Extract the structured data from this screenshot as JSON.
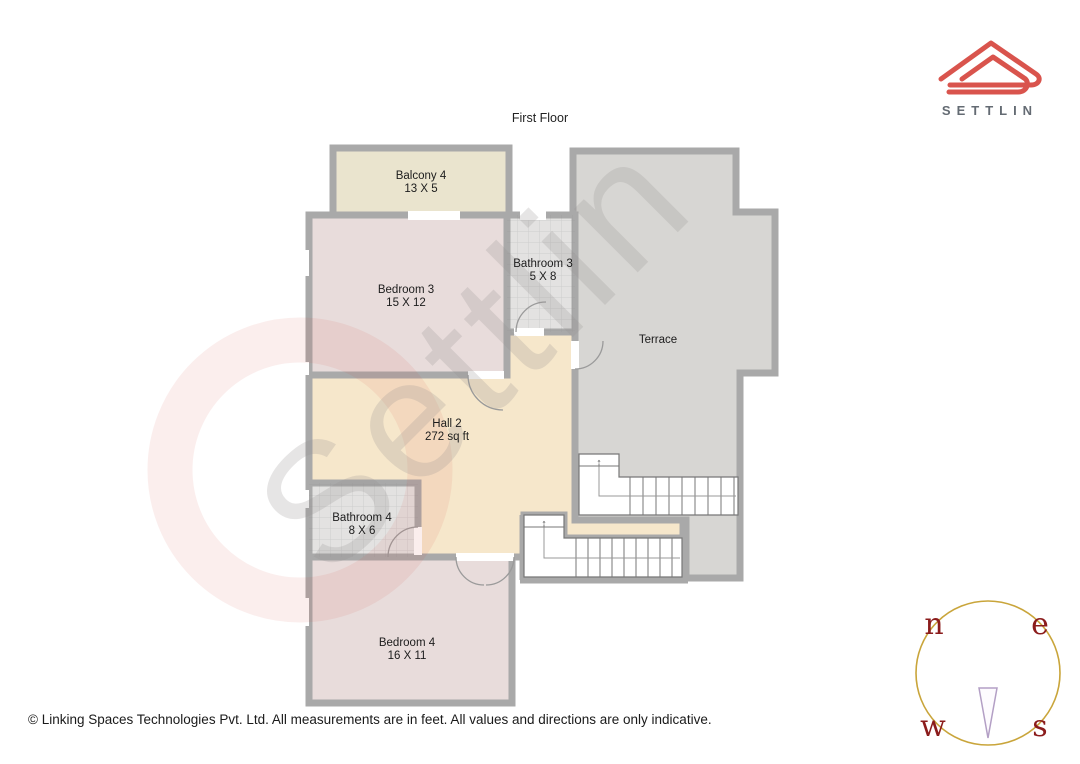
{
  "header": {
    "title": "First Floor"
  },
  "logo": {
    "brand": "SETTLIN"
  },
  "rooms": {
    "balcony4": {
      "name": "Balcony 4",
      "dims": "13 X 5"
    },
    "bedroom3": {
      "name": "Bedroom 3",
      "dims": "15 X 12"
    },
    "bathroom3": {
      "name": "Bathroom 3",
      "dims": "5 X 8"
    },
    "terrace": {
      "name": "Terrace"
    },
    "hall2": {
      "name": "Hall 2",
      "dims": "272 sq ft"
    },
    "bathroom4": {
      "name": "Bathroom 4",
      "dims": "8 X 6"
    },
    "bedroom4": {
      "name": "Bedroom 4",
      "dims": "16 X 11"
    }
  },
  "stairs": {
    "up_arrow": "↑"
  },
  "compass": {
    "north": "n",
    "east": "e",
    "west": "w",
    "south": "s"
  },
  "watermark": {
    "text": "Settlin"
  },
  "footer": {
    "copyright": "© Linking Spaces Technologies Pvt. Ltd. All measurements are in feet. All values and directions are only indicative."
  },
  "colors": {
    "wall": "#a9a9a9",
    "balcony": "#eae4ce",
    "bedroom": "#e8dcdb",
    "bathroom": "#e3e2e1",
    "hall": "#f6e7cb",
    "terrace": "#d7d6d3",
    "logo_red": "#d9544d",
    "brand_gray": "#646b73",
    "compass_ring": "#c9a53b",
    "compass_letters": "#8b1c1c",
    "compass_needle": "#b39fc5"
  }
}
